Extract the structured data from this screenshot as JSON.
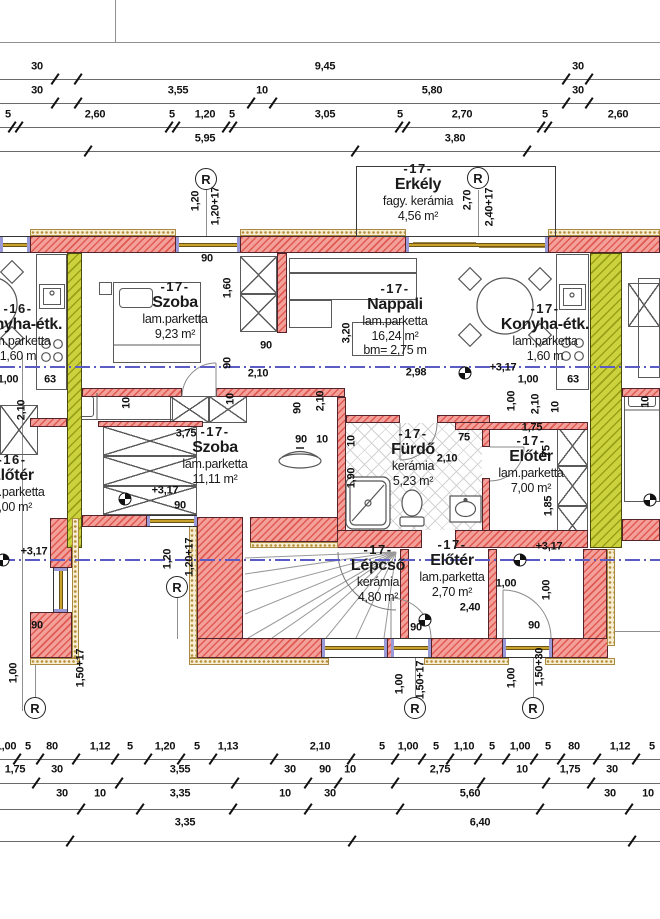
{
  "drawing": {
    "r_label": "R"
  },
  "rooms": [
    {
      "key": "erkely",
      "cx": 418,
      "top": 161,
      "lines": [
        "-17-",
        "Erkély",
        "fagy. kerámia",
        "4,56 m²"
      ]
    },
    {
      "key": "szoba-felso",
      "cx": 175,
      "top": 279,
      "lines": [
        "-17-",
        "Szoba",
        "lam.parketta",
        "9,23 m²"
      ]
    },
    {
      "key": "nappali",
      "cx": 395,
      "top": 281,
      "lines": [
        "-17-",
        "Nappali",
        "lam.parketta",
        "16,24 m²",
        "bm= 2,75 m"
      ]
    },
    {
      "key": "konyha-etk-jobb",
      "cx": 545,
      "top": 301,
      "lines": [
        "-17-",
        "Konyha-étk.",
        "lam.parketta",
        "1,60 m"
      ]
    },
    {
      "key": "konyha-etk-bal",
      "cx": 18,
      "top": 301,
      "lines": [
        "-16-",
        "Konyha-étk.",
        "lam.parketta",
        "1,60 m"
      ]
    },
    {
      "key": "szoba-also",
      "cx": 215,
      "top": 424,
      "lines": [
        "-17-",
        "Szoba",
        "lam.parketta",
        "11,11 m²"
      ]
    },
    {
      "key": "furdo",
      "cx": 413,
      "top": 426,
      "lines": [
        "-17-",
        "Fürdő",
        "kerámia",
        "5,23 m²"
      ]
    },
    {
      "key": "eloter-jobb",
      "cx": 531,
      "top": 433,
      "lines": [
        "-17-",
        "Előtér",
        "lam.parketta",
        "7,00 m²"
      ]
    },
    {
      "key": "eloter-bal",
      "cx": 12,
      "top": 452,
      "lines": [
        "-16-",
        "Előtér",
        "lam.parketta",
        "7,00 m²"
      ]
    },
    {
      "key": "lepcso",
      "cx": 378,
      "top": 542,
      "lines": [
        "-17-",
        "Lépcső",
        "kerámia",
        "4,80 m²"
      ]
    },
    {
      "key": "eloter-kozep",
      "cx": 452,
      "top": 537,
      "lines": [
        "-17-",
        "Előtér",
        "lam.parketta",
        "2,70 m²"
      ]
    }
  ],
  "chains": {
    "top": [
      {
        "ly": 67,
        "line": 79,
        "labels": [
          [
            "30",
            37
          ],
          [
            "9,45",
            325
          ],
          [
            "30",
            578
          ]
        ],
        "ticks": [
          55,
          78,
          566,
          589
        ]
      },
      {
        "ly": 91,
        "line": 103,
        "labels": [
          [
            "30",
            37
          ],
          [
            "3,55",
            178
          ],
          [
            "10",
            262
          ],
          [
            "5,80",
            432
          ],
          [
            "30",
            578
          ]
        ],
        "ticks": [
          55,
          78,
          251,
          273,
          566,
          589
        ]
      },
      {
        "ly": 115,
        "line": 127,
        "labels": [
          [
            "5",
            8
          ],
          [
            "2,60",
            95
          ],
          [
            "5",
            172
          ],
          [
            "1,20",
            205
          ],
          [
            "5",
            232
          ],
          [
            "3,05",
            325
          ],
          [
            "5",
            400
          ],
          [
            "2,70",
            462
          ],
          [
            "5",
            545
          ],
          [
            "2,60",
            618
          ]
        ],
        "ticks": [
          12,
          19,
          169,
          176,
          226,
          233,
          399,
          406,
          541,
          548
        ]
      },
      {
        "ly": 139,
        "line": 151,
        "labels": [
          [
            "5,95",
            205
          ],
          [
            "3,80",
            455
          ]
        ],
        "ticks": [
          88,
          355,
          527
        ]
      }
    ],
    "bottom": [
      {
        "ly": 747,
        "line": 759,
        "labels": [
          [
            "1,00",
            6
          ],
          [
            "5",
            28
          ],
          [
            "80",
            52
          ],
          [
            "1,12",
            100
          ],
          [
            "5",
            130
          ],
          [
            "1,20",
            165
          ],
          [
            "5",
            197
          ],
          [
            "1,13",
            228
          ],
          [
            "2,10",
            320
          ],
          [
            "5",
            382
          ],
          [
            "1,00",
            408
          ],
          [
            "5",
            436
          ],
          [
            "1,10",
            464
          ],
          [
            "5",
            492
          ],
          [
            "1,00",
            520
          ],
          [
            "5",
            548
          ],
          [
            "80",
            574
          ],
          [
            "1,12",
            620
          ],
          [
            "5",
            652
          ]
        ],
        "ticks": "auto"
      },
      {
        "ly": 770,
        "line": 783,
        "labels": [
          [
            "1,75",
            15
          ],
          [
            "30",
            57
          ],
          [
            "3,55",
            180
          ],
          [
            "30",
            290
          ],
          [
            "90",
            325
          ],
          [
            "10",
            350
          ],
          [
            "2,75",
            440
          ],
          [
            "10",
            522
          ],
          [
            "1,75",
            570
          ],
          [
            "30",
            612
          ]
        ],
        "ticks": "auto"
      },
      {
        "ly": 794,
        "line": 809,
        "labels": [
          [
            "30",
            62
          ],
          [
            "10",
            100
          ],
          [
            "3,35",
            180
          ],
          [
            "10",
            285
          ],
          [
            "30",
            330
          ],
          [
            "5,60",
            470
          ],
          [
            "30",
            610
          ],
          [
            "10",
            648
          ]
        ],
        "ticks": "auto"
      },
      {
        "ly": 823,
        "line": 841,
        "labels": [
          [
            "3,35",
            185
          ],
          [
            "6,40",
            480
          ]
        ],
        "ticks": [
          70,
          352,
          632
        ]
      }
    ]
  },
  "dims": [
    [
      "1,20",
      196,
      201,
      1
    ],
    [
      "1,20+17",
      216,
      206,
      1
    ],
    [
      "2,70",
      468,
      200,
      1
    ],
    [
      "2,40+17",
      490,
      207,
      1
    ],
    [
      "90",
      207,
      259,
      0
    ],
    [
      "1,60",
      228,
      288,
      1
    ],
    [
      "90",
      266,
      346,
      0
    ],
    [
      "90",
      228,
      363,
      1
    ],
    [
      "2,10",
      258,
      374,
      0
    ],
    [
      "3,20",
      347,
      333,
      1
    ],
    [
      "2,98",
      416,
      373,
      0
    ],
    [
      "+3,17",
      503,
      368,
      0
    ],
    [
      "1,00",
      512,
      401,
      1
    ],
    [
      "2,10",
      536,
      404,
      1
    ],
    [
      "10",
      556,
      407,
      1
    ],
    [
      "10",
      646,
      402,
      1
    ],
    [
      "1,00",
      8,
      380,
      0
    ],
    [
      "63",
      50,
      380,
      0
    ],
    [
      "1,00",
      528,
      380,
      0
    ],
    [
      "63",
      573,
      380,
      0
    ],
    [
      "2,10",
      22,
      410,
      1
    ],
    [
      "10",
      127,
      403,
      1
    ],
    [
      "10",
      231,
      399,
      1
    ],
    [
      "2,10",
      321,
      401,
      1
    ],
    [
      "90",
      298,
      408,
      1
    ],
    [
      "3,75",
      186,
      434,
      0
    ],
    [
      "90",
      301,
      440,
      0
    ],
    [
      "10",
      322,
      440,
      0
    ],
    [
      "10",
      352,
      441,
      1
    ],
    [
      "1,90",
      352,
      478,
      1
    ],
    [
      "75",
      464,
      438,
      0
    ],
    [
      "2,10",
      447,
      459,
      0
    ],
    [
      "1,75",
      532,
      428,
      0
    ],
    [
      "75",
      547,
      451,
      1
    ],
    [
      "1,85",
      549,
      506,
      1
    ],
    [
      "+3,17",
      165,
      491,
      0
    ],
    [
      "90",
      180,
      506,
      0
    ],
    [
      "1,20",
      168,
      559,
      1
    ],
    [
      "1,20+17",
      190,
      557,
      1
    ],
    [
      "+3,17",
      34,
      552,
      0
    ],
    [
      "+3,17",
      549,
      547,
      0
    ],
    [
      "90",
      37,
      626,
      0
    ],
    [
      "1,50+17",
      81,
      668,
      1
    ],
    [
      "1,00",
      14,
      673,
      1
    ],
    [
      "1,00",
      506,
      584,
      0
    ],
    [
      "1,00",
      547,
      590,
      1
    ],
    [
      "2,40",
      470,
      608,
      0
    ],
    [
      "90",
      416,
      628,
      0
    ],
    [
      "90",
      534,
      626,
      0
    ],
    [
      "1,00",
      400,
      684,
      1
    ],
    [
      "1,50+17",
      421,
      680,
      1
    ],
    [
      "1,00",
      512,
      678,
      1
    ],
    [
      "1,50+30",
      540,
      667,
      1
    ]
  ],
  "levels": [
    [
      465,
      373
    ],
    [
      125,
      499
    ],
    [
      650,
      500
    ],
    [
      425,
      620
    ],
    [
      520,
      560
    ],
    [
      3,
      560
    ]
  ],
  "r_markers": [
    [
      206,
      179
    ],
    [
      478,
      178
    ],
    [
      177,
      587
    ],
    [
      35,
      708
    ],
    [
      415,
      708
    ],
    [
      533,
      708
    ]
  ]
}
